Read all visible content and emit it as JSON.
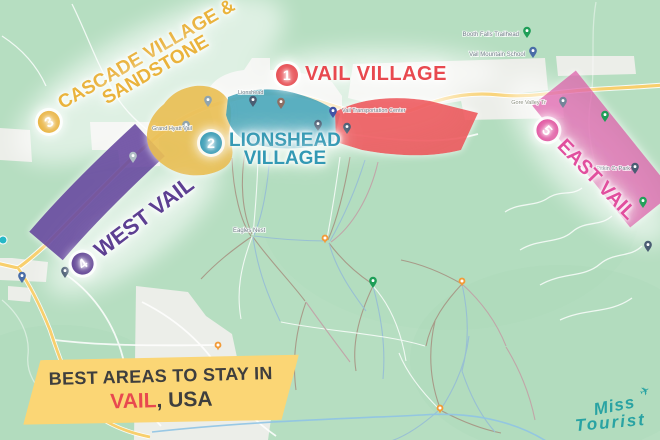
{
  "map": {
    "background_color": "#b6dec1",
    "road_color": "#f8cf6d",
    "urban_color": "#eceee9",
    "labels": {
      "booth_falls": "Booth Falls Trailhead",
      "mountain_school": "Vail Mountain School",
      "lionshead_town": "Lionshead",
      "grand_hyatt": "Grand Hyatt Vail",
      "eagles_nest": "Eagles Nest",
      "gore_valley": "Gore Valley Tr",
      "transportation": "Vail Transportation Center",
      "pitkin": "Pitkin Cr Park"
    }
  },
  "areas": [
    {
      "number": "1",
      "label": "VAIL VILLAGE",
      "color": "#e8494f",
      "region_fill": "#ee5a5e"
    },
    {
      "number": "2",
      "label_line1": "LIONSHEAD",
      "label_line2": "VILLAGE",
      "color": "#3399b4",
      "region_fill": "#4aa6ba"
    },
    {
      "number": "3",
      "label_line1": "CASCADE VILLAGE &",
      "label_line2": "SANDSTONE",
      "color": "#eab33c",
      "region_fill": "#eabf55"
    },
    {
      "number": "4",
      "label": "WEST VAIL",
      "color": "#5d3f92",
      "region_fill": "#6b4ba1"
    },
    {
      "number": "5",
      "label": "EAST VAIL",
      "color": "#e14f9e",
      "region_fill": "#df64ad"
    }
  ],
  "badge": {
    "line1": "BEST AREAS TO STAY IN",
    "city": "VAIL",
    "suffix": ", USA",
    "bg_color": "#fbd675"
  },
  "logo": {
    "word1": "Miss",
    "word2": "Tourist",
    "plane_icon": "✈",
    "color": "#29a3a3"
  }
}
